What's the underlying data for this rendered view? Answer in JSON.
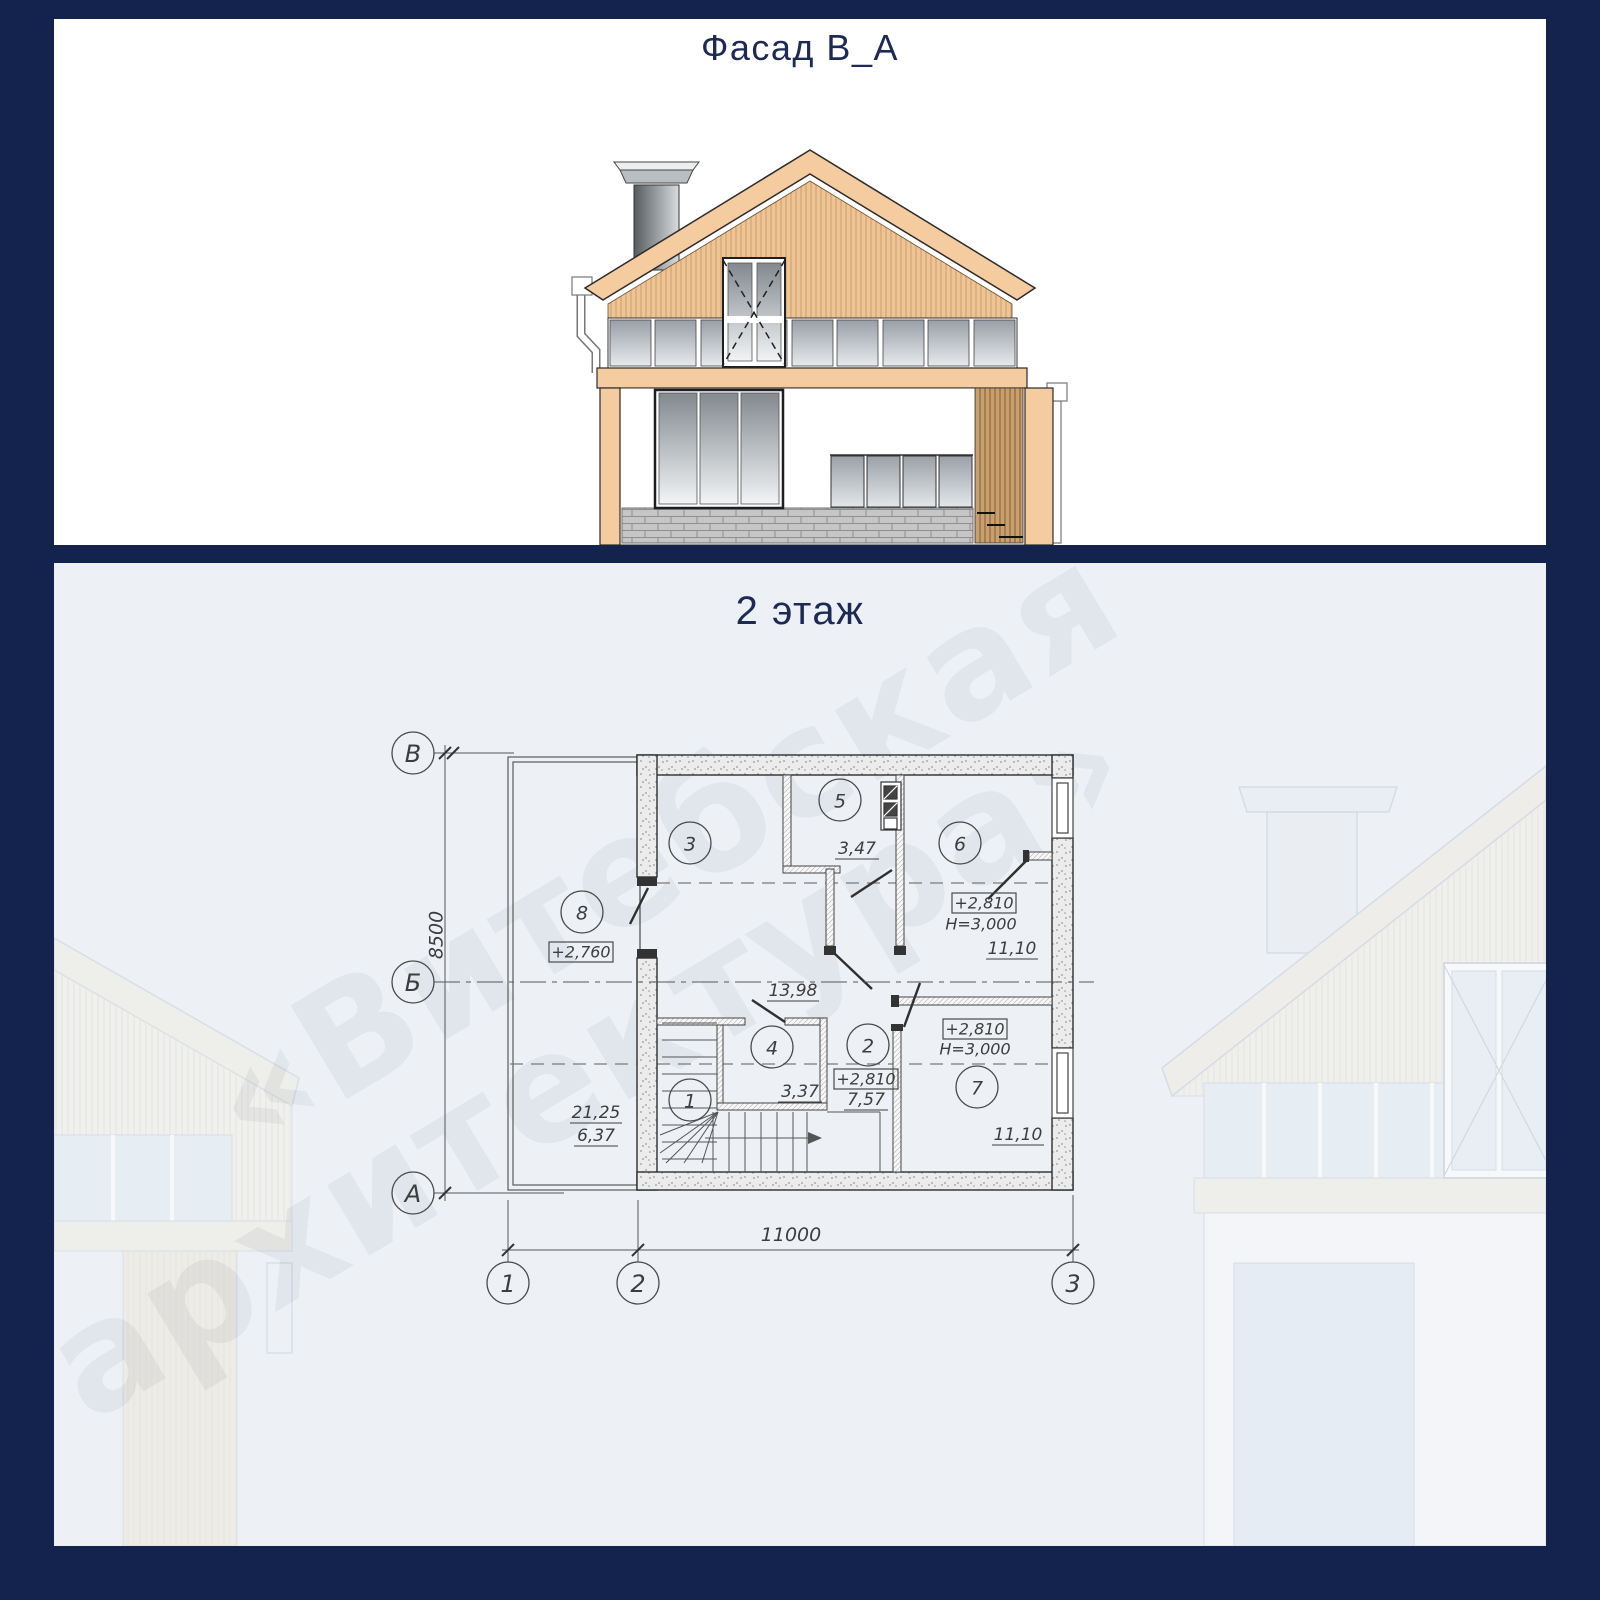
{
  "colors": {
    "frame": "#14234e",
    "panel_top_bg": "#ffffff",
    "panel_bottom_bg": "#edf1f6",
    "title_text": "#1d2a56",
    "facade_peach": "#f5cba0",
    "plan_line": "#3a3a3a"
  },
  "facade_panel": {
    "title": "Фасад В_А"
  },
  "plan_panel": {
    "title": "2 этаж",
    "watermark": {
      "line1": "«Витебская",
      "line2": "архитектура»"
    },
    "axes": {
      "v_top": "В",
      "v_mid": "Б",
      "v_bottom": "А",
      "h_left": "1",
      "h_mid": "2",
      "h_right": "3"
    },
    "dims": {
      "vertical": "8500",
      "horizontal": "11000"
    },
    "rooms": {
      "r1": {
        "num": "1"
      },
      "r2": {
        "num": "2",
        "level": "+2,810",
        "area": "7,57"
      },
      "r3": {
        "num": "3",
        "area": "13,98"
      },
      "r4": {
        "num": "4",
        "area": "3,37"
      },
      "r5": {
        "num": "5",
        "area": "3,47"
      },
      "r6": {
        "num": "6",
        "level": "+2,810",
        "height": "Н=3,000",
        "area": "11,10"
      },
      "r7": {
        "num": "7",
        "level": "+2,810",
        "height": "Н=3,000",
        "area": "11,10"
      },
      "r8": {
        "num": "8",
        "level": "+2,760"
      },
      "balcony": {
        "area_total": "21,25",
        "area_reduced": "6,37"
      }
    }
  }
}
